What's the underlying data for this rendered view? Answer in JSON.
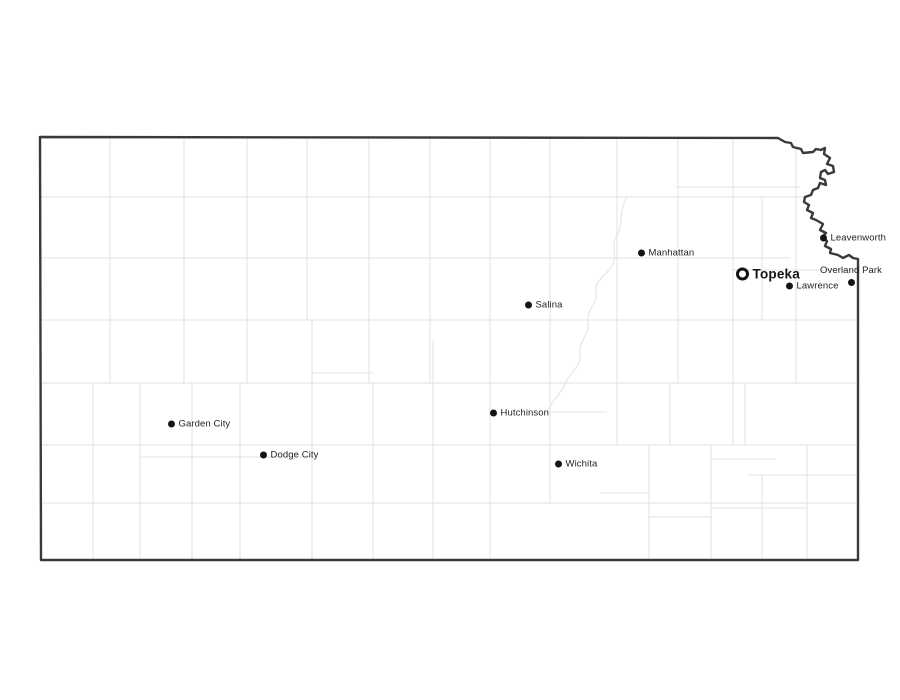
{
  "map": {
    "region": "Kansas",
    "kind": "state-outline-map-with-counties-and-cities",
    "cities": [
      {
        "name": "Garden City",
        "type": "city",
        "marker": "dot",
        "x": 171,
        "y": 424,
        "label_side": "right"
      },
      {
        "name": "Dodge City",
        "type": "city",
        "marker": "dot",
        "x": 263,
        "y": 455,
        "label_side": "right"
      },
      {
        "name": "Hutchinson",
        "type": "city",
        "marker": "dot",
        "x": 493,
        "y": 413,
        "label_side": "right"
      },
      {
        "name": "Wichita",
        "type": "city",
        "marker": "dot",
        "x": 558,
        "y": 464,
        "label_side": "right"
      },
      {
        "name": "Salina",
        "type": "city",
        "marker": "dot",
        "x": 528,
        "y": 305,
        "label_side": "right"
      },
      {
        "name": "Manhattan",
        "type": "city",
        "marker": "dot",
        "x": 641,
        "y": 253,
        "label_side": "right"
      },
      {
        "name": "Topeka",
        "type": "capital",
        "marker": "open-circle",
        "x": 742,
        "y": 274,
        "label_side": "right"
      },
      {
        "name": "Lawrence",
        "type": "city",
        "marker": "dot",
        "x": 789,
        "y": 286,
        "label_side": "right"
      },
      {
        "name": "Leavenworth",
        "type": "city",
        "marker": "dot",
        "x": 823,
        "y": 238,
        "label_side": "right"
      },
      {
        "name": "Overland Park",
        "type": "city",
        "marker": "dot",
        "x": 851,
        "y": 282,
        "label_side": "above"
      }
    ]
  },
  "colors": {
    "background": "#ffffff",
    "state_fill": "#ffffff",
    "state_border": "#3a3a3a",
    "county_lines": "#e2e2e2",
    "marker": "#141414",
    "label_text": "#1f1f1f"
  }
}
